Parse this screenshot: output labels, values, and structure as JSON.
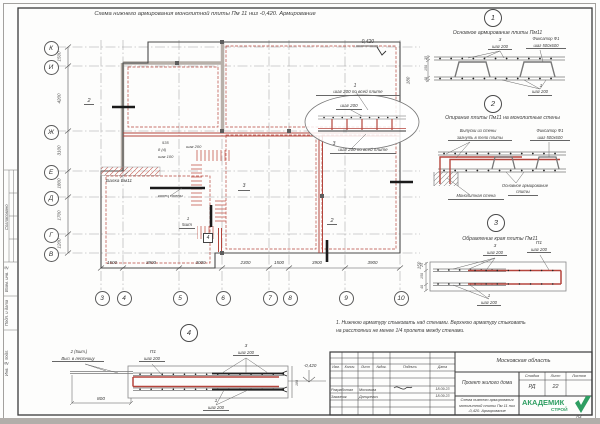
{
  "colors": {
    "reinforcement_red": "#b5453c",
    "line_dark": "#44423f",
    "wall_gray": "#b7b0a9",
    "logo_green": "#2f9e62",
    "paper": "#fdfdfc"
  },
  "sheet": {
    "title": "Схема нижнего армирования монолитной плиты Пм 11 низ -0,420. Армирование",
    "format": "А3"
  },
  "margin": {
    "v1": "Согласовано",
    "v2": "Взам. инв. №",
    "v3": "Подп. и дата",
    "v4": "Инв. № подл."
  },
  "plan": {
    "row_labels": [
      "К",
      "И",
      "Ж",
      "Е",
      "Д",
      "Г",
      "В"
    ],
    "row_dims": [
      "1500",
      "4200",
      "3100",
      "1800",
      "1700",
      "1200"
    ],
    "col_labels": [
      "3",
      "4",
      "5",
      "6",
      "7",
      "8",
      "9",
      "10"
    ],
    "col_dims": [
      "1500",
      "3900",
      "3000",
      "2300",
      "1500",
      "3900",
      "3900"
    ],
    "elevation": "-0,420",
    "dim_180": "180",
    "dim_150": "150",
    "top_num": "1",
    "top_step": "шаг 200 по всей плите",
    "oval_step": "шаг 200",
    "bot_num": "3",
    "bot_step": "шаг 200 по всей плите",
    "beam": "Балка Бм11",
    "wall_end": "конец стены",
    "m535": "535",
    "m84": "8 (4)",
    "m100": "шаг 100",
    "m200": "шаг 200",
    "count_num": "1",
    "count": "5шт",
    "box4": "4",
    "sec2": "2",
    "m3": "3"
  },
  "details": {
    "d1": {
      "num": "1",
      "title": "Основное армирование плиты Пм11",
      "top_num": "3",
      "top_step": "шаг 200",
      "fix1": "Фиксатор Ф1",
      "fix2": "шаг 500х600",
      "bot_num": "1",
      "bot_step": "шаг 200",
      "dims": [
        "25",
        "150",
        "40"
      ]
    },
    "d2": {
      "num": "2",
      "title": "Опирание плиты Пм11 на монолитные стены",
      "out1": "Выпуски из стены",
      "out2": "загнуть в тело плиты",
      "fix1": "Фиксатор Ф1",
      "fix2": "шаг 500х600",
      "base1": "Основное армирование",
      "base2": "плиты",
      "wall": "Монолитная стена"
    },
    "d3": {
      "num": "3",
      "title": "Обрамление края плиты Пм11",
      "top_num": "3",
      "top_step": "шаг 200",
      "p1": "П1",
      "p1_step": "шаг 200",
      "bot_num": "1",
      "bot_step": "шаг 200",
      "dims": [
        "25",
        "150",
        "40"
      ]
    },
    "d4": {
      "num": "4",
      "out1": "2 (5шт.)",
      "out2": "Вып. в лестницу",
      "p1": "П1",
      "p1_step": "шаг 200",
      "top_num": "3",
      "top_step": "шаг 200",
      "bot_num": "1",
      "bot_step": "шаг 200",
      "dim800": "800",
      "elevation": "-0,420",
      "dim180": "180"
    }
  },
  "note": {
    "line1": "1. Нижнюю арматуру стыковать над стенами. Верхнюю арматуру стыковать",
    "line2": "на расстоянии не менее 1/4 пролета между стенами."
  },
  "titleblock": {
    "region": "Московская область",
    "project": "Проект жилого дома",
    "doc1": "Схема нижнего армирования",
    "doc2": "монолитной плиты Пм 11 низ",
    "doc3": "-0,420. Армирование",
    "stage_label": "Стадия",
    "sheet_label": "Лист",
    "sheets_label": "Листов",
    "stage": "РД",
    "sheet_num": "22",
    "cols": [
      "Изм.",
      "Колич.",
      "Лист",
      "№док.",
      "Подпись",
      "Дата"
    ],
    "row1_role": "Разработал",
    "row1_name": "Москвина",
    "row1_date": "18.09.23",
    "row2_role": "Заказчик",
    "row2_name": "Данцкевич",
    "row2_date": "18.09.23",
    "logo1": "АКАДЕМИК",
    "logo2": "СТРОЙ"
  }
}
